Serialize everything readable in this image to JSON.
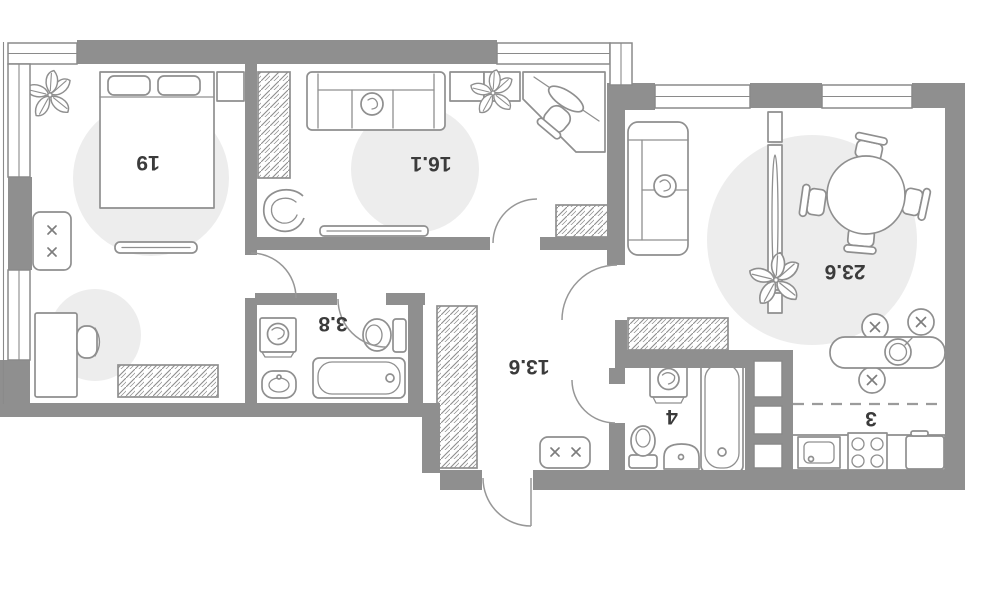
{
  "plan": {
    "rooms": [
      {
        "key": "bedroom",
        "label": "19"
      },
      {
        "key": "living-room",
        "label": "16.1"
      },
      {
        "key": "kitchen-living",
        "label": "23.6"
      },
      {
        "key": "bathroom-small",
        "label": "3.8"
      },
      {
        "key": "hallway",
        "label": "13.6"
      },
      {
        "key": "bathroom",
        "label": "4"
      },
      {
        "key": "kitchen-zone",
        "label": "3"
      }
    ],
    "colors": {
      "wall": "#8F8F8F",
      "furniture_line": "#8F8F8F",
      "light_zone": "#EDEDED",
      "label": "#3B3B3B",
      "background": "#FFFFFF"
    }
  }
}
